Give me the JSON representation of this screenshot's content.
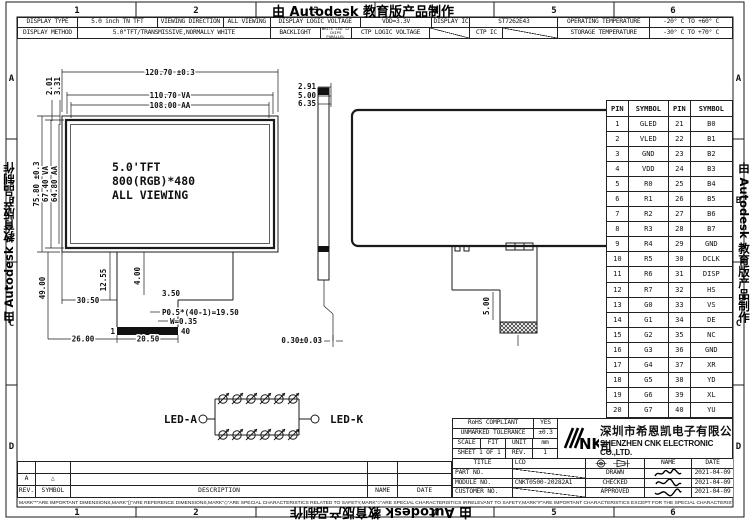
{
  "watermark": {
    "text": "由 Autodesk 教育版产品制作"
  },
  "border": {
    "cols": [
      "1",
      "2",
      "3",
      "4",
      "5",
      "6"
    ],
    "rows": [
      "A",
      "B",
      "C",
      "D"
    ]
  },
  "spec_r1": [
    "DISPLAY TYPE",
    "5.0 inch TN TFT",
    "VIEWING DIRECTION",
    "ALL VIEWING",
    "DISPLAY LOGIC VOLTAGE",
    "VDD=3.3V",
    "DISPLAY IC",
    "ST7262E43",
    "OPERATING TEMPERATURE",
    "-20° C TO +60° C"
  ],
  "spec_r2": [
    "DISPLAY METHOD",
    "5.0\"TFT/TRANSMISSIVE,NORMALLY WHITE",
    "BACKLIGHT",
    "WHITE LED 12 CHIPS PARALLEL",
    "CTP LOGIC VOLTAGE",
    "",
    "CTP IC",
    "",
    "STORAGE TEMPERATURE",
    "-30° C TO +70° C"
  ],
  "front_view": {
    "l1": "5.0'TFT",
    "l2": "800(RGB)*480",
    "l3": "ALL VIEWING"
  },
  "dims": {
    "overall_w": "120.70 ±0.3",
    "va_w": "110.70 VA",
    "aa_w": "108.00 AA",
    "tr1": "2.91",
    "tr2": "5.00",
    "tr3": "6.35",
    "tl1": "2.01",
    "tl2": "3.31",
    "overall_h": "75.80 ±0.3",
    "va_h": "67.40 VA",
    "aa_h": "64.80 AA",
    "tail_len": "49.00",
    "tail_off": "30.50",
    "neck1": "12.55",
    "neck2": "4.00",
    "neck3": "3.50",
    "pitch": "P0.5*(40-1)=19.50",
    "pin_w": "W=0.35",
    "pin_first": "1",
    "pin_last": "40",
    "bot1": "26.00",
    "bot2": "20.50",
    "thickness": "0.30±0.03",
    "conn_h": "5.00"
  },
  "led": {
    "anode": "LED-A",
    "cathode": "LED-K"
  },
  "pin_table": {
    "headers": [
      "PIN",
      "SYMBOL",
      "PIN",
      "SYMBOL"
    ],
    "rows": [
      [
        "1",
        "GLED",
        "21",
        "B0"
      ],
      [
        "2",
        "VLED",
        "22",
        "B1"
      ],
      [
        "3",
        "GND",
        "23",
        "B2"
      ],
      [
        "4",
        "VDD",
        "24",
        "B3"
      ],
      [
        "5",
        "R0",
        "25",
        "B4"
      ],
      [
        "6",
        "R1",
        "26",
        "B5"
      ],
      [
        "7",
        "R2",
        "27",
        "B6"
      ],
      [
        "8",
        "R3",
        "28",
        "B7"
      ],
      [
        "9",
        "R4",
        "29",
        "GND"
      ],
      [
        "10",
        "R5",
        "30",
        "DCLK"
      ],
      [
        "11",
        "R6",
        "31",
        "DISP"
      ],
      [
        "12",
        "R7",
        "32",
        "HS"
      ],
      [
        "13",
        "G0",
        "33",
        "VS"
      ],
      [
        "14",
        "G1",
        "34",
        "DE"
      ],
      [
        "15",
        "G2",
        "35",
        "NC"
      ],
      [
        "16",
        "G3",
        "36",
        "GND"
      ],
      [
        "17",
        "G4",
        "37",
        "XR"
      ],
      [
        "18",
        "G5",
        "38",
        "YD"
      ],
      [
        "19",
        "G6",
        "39",
        "XL"
      ],
      [
        "20",
        "G7",
        "40",
        "YU"
      ]
    ]
  },
  "revision_table": {
    "headers": [
      "REV.",
      "SYMBOL",
      "DESCRIPTION",
      "NAME",
      "DATE"
    ],
    "entry_rev": "A",
    "entry_symbol": "△"
  },
  "note": "MARK\"*\"ARE IMPORTANT DIMENSIONS,MARK\"()\"ARE REFERENCE DIMENSIONS,MARK\"◇\"ARE SPECIAL CHARACTERISTICS RELATED TO SAFETY,MARK\"○\"ARE SPECIAL CHARACTERISTICS IRRELEVANT TO SAFETY,MARK\"#\"ARE IMPORTANT CHARACTERISTICS EXCEPT FOR THE SPECIAL CHARACTERISTICS.",
  "title_block": {
    "rohs_label": "RoHS COMPLIANT",
    "rohs_value": "YES",
    "tol_label": "UNMARKED TOLERANCE",
    "tol_value": "±0.3",
    "scale_label": "SCALE",
    "scale_value": "FIT",
    "unit_label": "UNIT",
    "unit_value": "mm",
    "sheet_label": "SHEET 1 OF 1",
    "rev_label": "REV.",
    "rev_value": "1",
    "logo_text": "NK",
    "company_cn": "深圳市希恩凯电子有限公司",
    "company_en": "SHENZHEN CNK ELECTRONIC CO.,LTD.",
    "title_label": "TITLE",
    "title_value": "LCD",
    "part_label": "PART NO.",
    "module_label": "MODULE NO.",
    "module_value": "CNKT0500-20282A1",
    "customer_label": "CUSTOMER NO.",
    "name_label": "NAME",
    "date_label": "DATE",
    "drawn_label": "DRAWN",
    "checked_label": "CHECKED",
    "approved_label": "APPROVED",
    "drawn_date": "2021-04-09",
    "checked_date": "2021-04-09",
    "approved_date": "2021-04-09"
  }
}
